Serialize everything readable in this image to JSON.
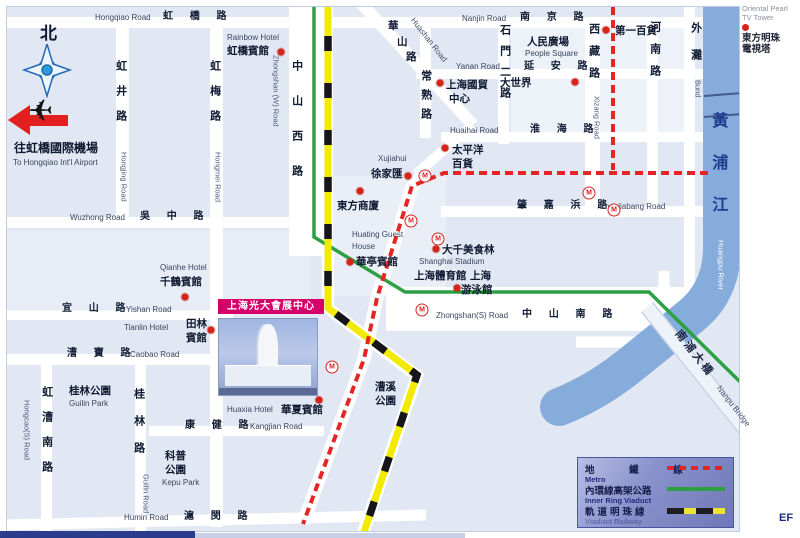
{
  "icons": {
    "metro_station": "M",
    "airplane": "✈"
  },
  "colors": {
    "metro_line": "#e52525",
    "ring_line": "#2da043",
    "pearl_line_yellow": "#f2ea00",
    "river": "#85acda",
    "highlight_box": "#d6006b"
  },
  "margin": {
    "oriental_pearl_en1": "Oriental Pearl",
    "oriental_pearl_en2": "TV Tower",
    "oriental_pearl_zh1": "東方明珠",
    "oriental_pearl_zh2": "電視塔",
    "corner_note": "EF"
  },
  "exhibition": {
    "caption": "上海光大會展中心",
    "en1": "Shanghai Everbright Convention",
    "en2": "& Exhibition Center"
  },
  "legend": {
    "rows": [
      {
        "zh": "地 鐵 線",
        "en": "Metro",
        "sample": "metro"
      },
      {
        "zh": "內環線高架公路",
        "en": "Inner Ring Viaduct",
        "sample": "ring"
      },
      {
        "zh": "軌道明珠線",
        "en": "Viaduct Railway",
        "sample": "pearl"
      }
    ]
  },
  "map": {
    "labels": [
      {
        "n": "hongqiao-road-en",
        "k": "en",
        "t": "Hongqiao Road",
        "x": 95,
        "y": 13
      },
      {
        "n": "hongqiao-road-zh",
        "k": "zhs",
        "t": "虹 橋 路",
        "x": 163,
        "y": 11
      },
      {
        "n": "nanjing-road-en",
        "k": "en",
        "t": "Nanjin Road",
        "x": 462,
        "y": 14
      },
      {
        "n": "nanjing-road-zh",
        "k": "zhs",
        "t": "南 京 路",
        "x": 520,
        "y": 12
      },
      {
        "n": "yanan-road-en",
        "k": "en",
        "t": "Yanan Road",
        "x": 456,
        "y": 62
      },
      {
        "n": "yanan-road-zh",
        "k": "zhs",
        "t": "延 安 路",
        "x": 524,
        "y": 61
      },
      {
        "n": "huaihai-road-en",
        "k": "en",
        "t": "Huaihai Road",
        "x": 450,
        "y": 126
      },
      {
        "n": "huaihai-road-zh",
        "k": "zhs",
        "t": "淮 海 路",
        "x": 530,
        "y": 124
      },
      {
        "n": "zhaojiabang-road-zh",
        "k": "zhs",
        "t": "肇 嘉 浜 路",
        "x": 517,
        "y": 200
      },
      {
        "n": "zhaojiabang-road-en",
        "k": "en",
        "t": "Zhaojiabang Road",
        "x": 600,
        "y": 202
      },
      {
        "n": "wuzhong-road-en",
        "k": "en",
        "t": "Wuzhong Road",
        "x": 70,
        "y": 213
      },
      {
        "n": "wuzhong-road-zh",
        "k": "zhs",
        "t": "吳 中 路",
        "x": 140,
        "y": 211
      },
      {
        "n": "yishan-road-zh",
        "k": "zhs",
        "t": "宜 山 路",
        "x": 62,
        "y": 303
      },
      {
        "n": "yishan-road-en",
        "k": "en",
        "t": "Yishan Road",
        "x": 126,
        "y": 305
      },
      {
        "n": "caobao-road-zh",
        "k": "zhs",
        "t": "漕 寶 路",
        "x": 67,
        "y": 348
      },
      {
        "n": "caobao-road-en",
        "k": "en",
        "t": "Caobao Road",
        "x": 130,
        "y": 350
      },
      {
        "n": "kangjian-road-zh",
        "k": "zhs",
        "t": "康 健 路",
        "x": 185,
        "y": 420
      },
      {
        "n": "kangjian-road-en",
        "k": "en",
        "t": "Kangjian Road",
        "x": 250,
        "y": 422
      },
      {
        "n": "humin-road-en",
        "k": "en",
        "t": "Humin Road",
        "x": 124,
        "y": 513
      },
      {
        "n": "humin-road-zh",
        "k": "zhs",
        "t": "滬 閔 路",
        "x": 184,
        "y": 511
      },
      {
        "n": "zhongshan-s-road-en",
        "k": "en",
        "t": "Zhongshan(S) Road",
        "x": 436,
        "y": 311
      },
      {
        "n": "zhongshan-s-road-zh",
        "k": "zhs",
        "t": "中 山 南 路",
        "x": 522,
        "y": 309
      },
      {
        "n": "hongjing-road-zh",
        "k": "vzh",
        "t": "虹井路",
        "x": 114,
        "y": 60,
        "ls": 14
      },
      {
        "n": "hongjing-road-en",
        "k": "ven",
        "t": "Hongjing Road",
        "x": 119,
        "y": 152
      },
      {
        "n": "hongmei-road-zh",
        "k": "vzh",
        "t": "虹梅路",
        "x": 208,
        "y": 60,
        "ls": 14
      },
      {
        "n": "hongmei-road-en",
        "k": "ven",
        "t": "Hongmei Road",
        "x": 213,
        "y": 152
      },
      {
        "n": "zhongshan-w-road-zh",
        "k": "vzh",
        "t": "中山西路",
        "x": 290,
        "y": 60,
        "ls": 24
      },
      {
        "n": "zhongshan-w-road-en",
        "k": "ven",
        "t": "Zhongshan (W) Road",
        "x": 271,
        "y": 55
      },
      {
        "n": "changshu-road-zh",
        "k": "vzh",
        "t": "常熟路",
        "x": 419,
        "y": 70,
        "ls": 8
      },
      {
        "n": "shimen-er-road-zh",
        "k": "vzh",
        "t": "石門二路",
        "x": 498,
        "y": 24,
        "ls": 10
      },
      {
        "n": "xizang-road-zh",
        "k": "vzh",
        "t": "西藏路",
        "x": 587,
        "y": 23,
        "ls": 11
      },
      {
        "n": "xizang-road-en",
        "k": "ven",
        "t": "Xizang Road",
        "x": 592,
        "y": 96
      },
      {
        "n": "henan-road-zh",
        "k": "vzh",
        "t": "河南路",
        "x": 648,
        "y": 21,
        "ls": 11
      },
      {
        "n": "bund-zh",
        "k": "vzh",
        "t": "外灘",
        "x": 689,
        "y": 22,
        "ls": 16
      },
      {
        "n": "bund-en",
        "k": "ven",
        "t": "Bund",
        "x": 693,
        "y": 80
      },
      {
        "n": "hongcao-s-road-zh",
        "k": "vzh",
        "t": "虹漕南路",
        "x": 40,
        "y": 386,
        "ls": 14
      },
      {
        "n": "hongcao-s-road-en",
        "k": "ven",
        "t": "Hongcao(S) Road",
        "x": 22,
        "y": 400
      },
      {
        "n": "guilin-road-zh",
        "k": "vzh",
        "t": "桂林路",
        "x": 132,
        "y": 388,
        "ls": 16
      },
      {
        "n": "guilin-road-en",
        "k": "ven",
        "t": "Guilin Road",
        "x": 141,
        "y": 474
      },
      {
        "n": "huashan-road-zh-1",
        "k": "zh",
        "t": "華",
        "x": 388,
        "y": 20
      },
      {
        "n": "huashan-road-zh-2",
        "k": "zh",
        "t": "山",
        "x": 397,
        "y": 36
      },
      {
        "n": "huashan-road-zh-3",
        "k": "zh",
        "t": "路",
        "x": 406,
        "y": 51
      },
      {
        "n": "huashan-road-en",
        "k": "diag",
        "t": "Huashan Road",
        "x": 416,
        "y": 16,
        "rot": 52
      },
      {
        "n": "nanpu-bridge-zh",
        "k": "diag",
        "t": "南浦大橋",
        "x": 682,
        "y": 328,
        "rot": 52,
        "fs": 11,
        "w": 700,
        "ls": 3,
        "color": "#1a2442"
      },
      {
        "n": "nanpu-bridge-en",
        "k": "diag",
        "t": "Nanpu Bridge",
        "x": 722,
        "y": 384,
        "rot": 52
      },
      {
        "n": "huangpu-river-zh",
        "k": "vzh",
        "t": "黃浦江",
        "x": 708,
        "y": 112,
        "ls": 26,
        "fs": 16,
        "color": "#1d3d8f"
      },
      {
        "n": "huangpu-river-en",
        "k": "ven",
        "t": "Huangpu River",
        "x": 716,
        "y": 240,
        "color": "#ffffff"
      },
      {
        "n": "rainbow-hotel-en",
        "k": "en",
        "t": "Rainbow Hotel",
        "x": 227,
        "y": 33
      },
      {
        "n": "rainbow-hotel-zh",
        "k": "zh",
        "t": "虹橋賓館",
        "x": 227,
        "y": 45
      },
      {
        "n": "people-square-zh",
        "k": "zh",
        "t": "人民廣場",
        "x": 527,
        "y": 36
      },
      {
        "n": "people-square-en",
        "k": "en",
        "t": "People Square",
        "x": 525,
        "y": 49
      },
      {
        "n": "no1-department-store-zh",
        "k": "zh",
        "t": "第一百貨",
        "x": 615,
        "y": 25
      },
      {
        "n": "great-world-zh",
        "k": "zh",
        "t": "大世界",
        "x": 500,
        "y": 77
      },
      {
        "n": "intl-trade-center-zh1",
        "k": "zh",
        "t": "上海國貿",
        "x": 446,
        "y": 79
      },
      {
        "n": "intl-trade-center-zh2",
        "k": "zh",
        "t": "中心",
        "x": 449,
        "y": 93
      },
      {
        "n": "pacific-store-zh1",
        "k": "zh",
        "t": "太平洋",
        "x": 452,
        "y": 144
      },
      {
        "n": "pacific-store-zh2",
        "k": "zh",
        "t": "百貨",
        "x": 452,
        "y": 158
      },
      {
        "n": "xujiahui-en",
        "k": "en",
        "t": "Xujiahui",
        "x": 378,
        "y": 154
      },
      {
        "n": "xujiahui-zh",
        "k": "zh",
        "t": "徐家匯",
        "x": 371,
        "y": 168
      },
      {
        "n": "oriental-department-zh",
        "k": "zh",
        "t": "東方商廈",
        "x": 337,
        "y": 200
      },
      {
        "n": "huating-guest-house-en1",
        "k": "en",
        "t": "Huating Guest",
        "x": 352,
        "y": 230
      },
      {
        "n": "huating-guest-house-en2",
        "k": "en",
        "t": "House",
        "x": 352,
        "y": 242
      },
      {
        "n": "huating-guest-house-zh",
        "k": "zh",
        "t": "華亭賓館",
        "x": 356,
        "y": 256
      },
      {
        "n": "daqian-food-zh",
        "k": "zh",
        "t": "大千美食林",
        "x": 442,
        "y": 244
      },
      {
        "n": "shanghai-stadium-en",
        "k": "en",
        "t": "Shanghai Stadium",
        "x": 419,
        "y": 257
      },
      {
        "n": "shanghai-stadium-zh",
        "k": "zh",
        "t": "上海體育館",
        "x": 414,
        "y": 270
      },
      {
        "n": "swimming-pool-zh1",
        "k": "zh",
        "t": "上海",
        "x": 470,
        "y": 270
      },
      {
        "n": "swimming-pool-zh2",
        "k": "zh",
        "t": "游泳館",
        "x": 461,
        "y": 284
      },
      {
        "n": "qianhe-hotel-en",
        "k": "en",
        "t": "Qianhe Hotel",
        "x": 160,
        "y": 263
      },
      {
        "n": "qianhe-hotel-zh",
        "k": "zh",
        "t": "千鶴賓館",
        "x": 160,
        "y": 276
      },
      {
        "n": "tianlin-hotel-en",
        "k": "en",
        "t": "Tianlin Hotel",
        "x": 124,
        "y": 323
      },
      {
        "n": "tianlin-hotel-zh1",
        "k": "zh",
        "t": "田林",
        "x": 186,
        "y": 318
      },
      {
        "n": "tianlin-hotel-zh2",
        "k": "zh",
        "t": "賓館",
        "x": 186,
        "y": 332
      },
      {
        "n": "guilin-park-zh",
        "k": "zh",
        "t": "桂林公園",
        "x": 69,
        "y": 385
      },
      {
        "n": "guilin-park-en",
        "k": "en",
        "t": "Guilin Park",
        "x": 69,
        "y": 399
      },
      {
        "n": "kepu-park-zh1",
        "k": "zh",
        "t": "科普",
        "x": 165,
        "y": 450
      },
      {
        "n": "kepu-park-zh2",
        "k": "zh",
        "t": "公園",
        "x": 165,
        "y": 464
      },
      {
        "n": "kepu-park-en",
        "k": "en",
        "t": "Kepu Park",
        "x": 162,
        "y": 478
      },
      {
        "n": "caoxi-park-zh1",
        "k": "zh",
        "t": "漕溪",
        "x": 375,
        "y": 381
      },
      {
        "n": "caoxi-park-zh2",
        "k": "zh",
        "t": "公園",
        "x": 375,
        "y": 395
      },
      {
        "n": "huaxia-hotel-en",
        "k": "en",
        "t": "Huaxia Hotel",
        "x": 227,
        "y": 405
      },
      {
        "n": "huaxia-hotel-zh",
        "k": "zh",
        "t": "華夏賓館",
        "x": 281,
        "y": 404
      },
      {
        "n": "north-label",
        "k": "zh",
        "t": "北",
        "x": 40,
        "y": 24,
        "fs": 17
      },
      {
        "n": "airport-zh",
        "k": "zh",
        "t": "往虹橋國際機場",
        "x": 14,
        "y": 142,
        "fs": 12
      },
      {
        "n": "airport-en",
        "k": "en",
        "t": "To Hongqiao Int'l Airport",
        "x": 13,
        "y": 158
      }
    ],
    "dots": [
      [
        281,
        52
      ],
      [
        606,
        30
      ],
      [
        575,
        82
      ],
      [
        440,
        83
      ],
      [
        445,
        148
      ],
      [
        408,
        176
      ],
      [
        360,
        191
      ],
      [
        350,
        262
      ],
      [
        436,
        249
      ],
      [
        457,
        288
      ],
      [
        185,
        297
      ],
      [
        211,
        330
      ],
      [
        319,
        400
      ]
    ],
    "stations": [
      [
        425,
        176
      ],
      [
        411,
        221
      ],
      [
        438,
        239
      ],
      [
        422,
        310
      ],
      [
        332,
        367
      ],
      [
        589,
        193
      ],
      [
        614,
        210
      ]
    ]
  }
}
